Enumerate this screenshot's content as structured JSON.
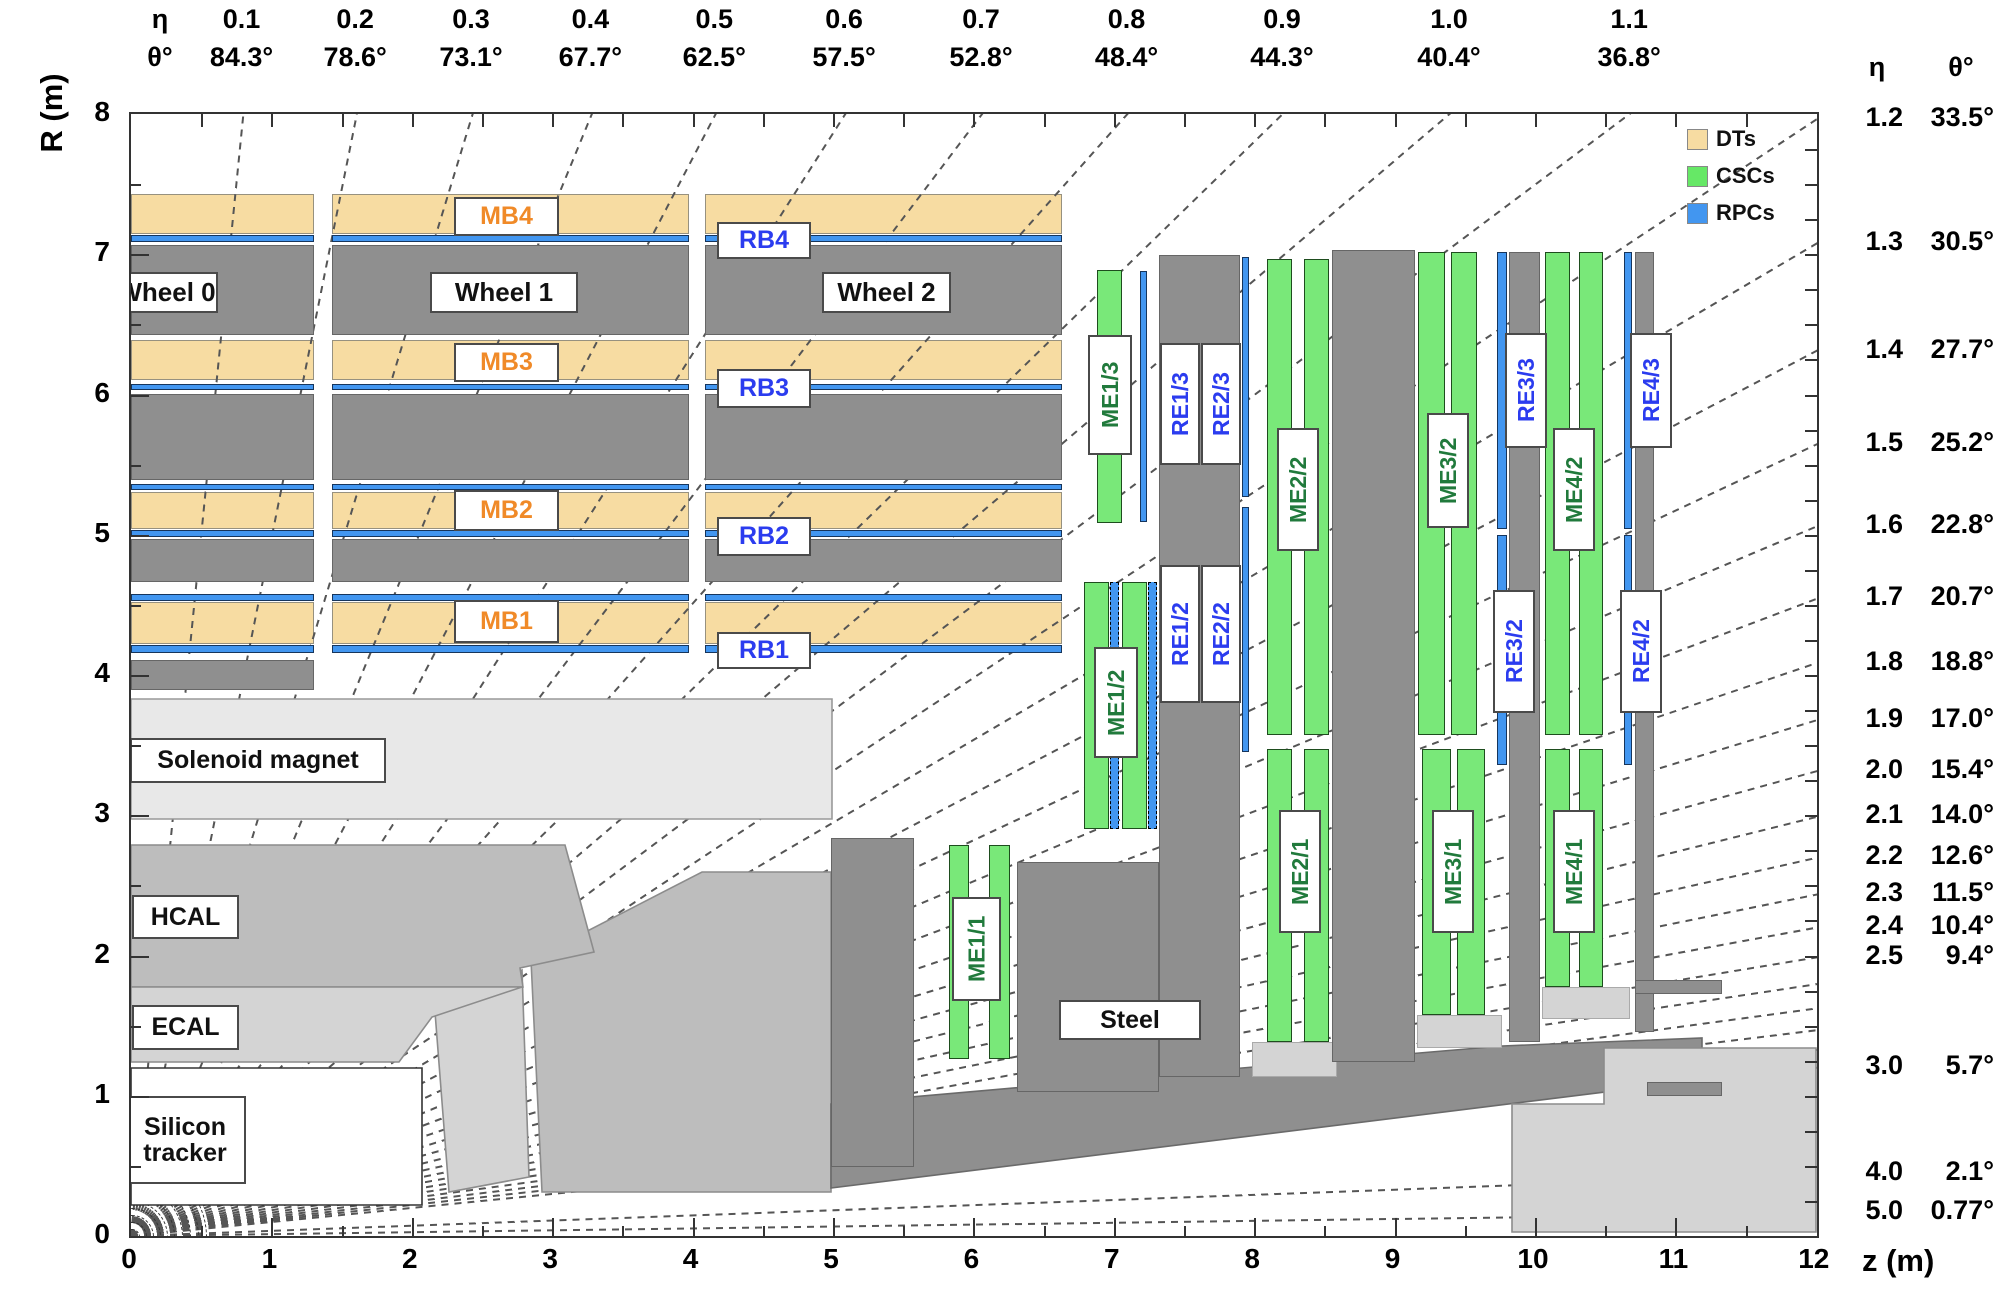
{
  "axes": {
    "r_axis_title": "R (m)",
    "z_axis_title": "z (m)",
    "r_tick_labels": [
      "0",
      "1",
      "2",
      "3",
      "4",
      "5",
      "6",
      "7",
      "8"
    ],
    "z_tick_labels": [
      "0",
      "1",
      "2",
      "3",
      "4",
      "5",
      "6",
      "7",
      "8",
      "9",
      "10",
      "11",
      "12"
    ],
    "top_header_eta": "η",
    "top_header_theta": "θ°",
    "right_header_eta": "η",
    "right_header_theta": "θ°",
    "top_eta_labels": [
      {
        "eta": "0.1",
        "theta": "84.3°"
      },
      {
        "eta": "0.2",
        "theta": "78.6°"
      },
      {
        "eta": "0.3",
        "theta": "73.1°"
      },
      {
        "eta": "0.4",
        "theta": "67.7°"
      },
      {
        "eta": "0.5",
        "theta": "62.5°"
      },
      {
        "eta": "0.6",
        "theta": "57.5°"
      },
      {
        "eta": "0.7",
        "theta": "52.8°"
      },
      {
        "eta": "0.8",
        "theta": "48.4°"
      },
      {
        "eta": "0.9",
        "theta": "44.3°"
      },
      {
        "eta": "1.0",
        "theta": "40.4°"
      },
      {
        "eta": "1.1",
        "theta": "36.8°"
      }
    ],
    "right_eta_labels": [
      {
        "eta": "1.2",
        "theta": "33.5°"
      },
      {
        "eta": "1.3",
        "theta": "30.5°"
      },
      {
        "eta": "1.4",
        "theta": "27.7°"
      },
      {
        "eta": "1.5",
        "theta": "25.2°"
      },
      {
        "eta": "1.6",
        "theta": "22.8°"
      },
      {
        "eta": "1.7",
        "theta": "20.7°"
      },
      {
        "eta": "1.8",
        "theta": "18.8°"
      },
      {
        "eta": "1.9",
        "theta": "17.0°"
      },
      {
        "eta": "2.0",
        "theta": "15.4°"
      },
      {
        "eta": "2.1",
        "theta": "14.0°"
      },
      {
        "eta": "2.2",
        "theta": "12.6°"
      },
      {
        "eta": "2.3",
        "theta": "11.5°"
      },
      {
        "eta": "2.4",
        "theta": "10.4°"
      },
      {
        "eta": "2.5",
        "theta": "9.4°"
      },
      {
        "eta": "3.0",
        "theta": "5.7°"
      },
      {
        "eta": "4.0",
        "theta": "2.1°"
      },
      {
        "eta": "5.0",
        "theta": "0.77°"
      }
    ],
    "unlabeled_eta_lines": [
      2.6,
      2.7,
      2.8,
      2.9
    ]
  },
  "legend": [
    {
      "label": "DTs",
      "color": "#F7DCA2",
      "icon": "dt-swatch"
    },
    {
      "label": "CSCs",
      "color": "#66E866",
      "icon": "csc-swatch"
    },
    {
      "label": "RPCs",
      "color": "#4296F0",
      "icon": "rpc-swatch"
    }
  ],
  "colors": {
    "dt_tan": "#F7DCA2",
    "csc_green": "#79E879",
    "rpc_blue": "#4296F0",
    "steel_gray": "#8F8F8F",
    "solenoid": "#E8E8E8",
    "hcal": "#BDBDBD",
    "ecal": "#D4D4D4",
    "light_steel": "#D4D4D4",
    "mb_text": "#F08A28",
    "rb_text": "#2B3CEF",
    "me_text": "#217A3C"
  },
  "geometry": {
    "frame": {
      "x0": 129,
      "y0": 112,
      "x1": 1815,
      "y1": 1234
    },
    "origin": {
      "x": 129,
      "y": 1234
    },
    "px_per_m_z": 140.4,
    "px_per_m_r": 140.25,
    "wheels": [
      [
        129,
        312
      ],
      [
        330,
        687
      ],
      [
        703,
        1060
      ]
    ],
    "tan_rows": [
      [
        192,
        232
      ],
      [
        338,
        378
      ],
      [
        490,
        527
      ],
      [
        600,
        642
      ]
    ],
    "rpc_rows": [
      [
        233,
        240
      ],
      [
        382,
        388
      ],
      [
        482,
        488
      ],
      [
        528,
        535
      ],
      [
        592,
        599
      ],
      [
        643,
        651
      ]
    ],
    "gray_rows": [
      [
        243,
        333
      ],
      [
        392,
        478
      ],
      [
        537,
        580
      ]
    ],
    "wheel0_stub": [
      129,
      312,
      658,
      688
    ],
    "beam_arc_radii": [
      7,
      14,
      21,
      28,
      35,
      42,
      50,
      58,
      66,
      74
    ],
    "green_bars": [
      [
        947,
        967,
        843,
        1057
      ],
      [
        987,
        1008,
        843,
        1057
      ],
      [
        1082,
        1107,
        580,
        827
      ],
      [
        1120,
        1145,
        580,
        827
      ],
      [
        1095,
        1120,
        268,
        521
      ],
      [
        1265,
        1290,
        257,
        733
      ],
      [
        1302,
        1327,
        257,
        733
      ],
      [
        1265,
        1290,
        747,
        1040
      ],
      [
        1302,
        1327,
        747,
        1040
      ],
      [
        1416,
        1443,
        250,
        733
      ],
      [
        1449,
        1475,
        250,
        733
      ],
      [
        1420,
        1449,
        747,
        1013
      ],
      [
        1455,
        1483,
        747,
        1013
      ],
      [
        1543,
        1568,
        250,
        733
      ],
      [
        1577,
        1601,
        250,
        733
      ],
      [
        1543,
        1568,
        747,
        985
      ],
      [
        1577,
        1601,
        747,
        985
      ]
    ],
    "rpc_dashed_bars": [
      [
        1108,
        1117,
        580,
        827
      ],
      [
        1146,
        1155,
        580,
        827
      ]
    ],
    "rpc_solid_bars": [
      [
        1138,
        1145,
        269,
        520
      ],
      [
        1240,
        1247,
        255,
        495
      ],
      [
        1240,
        1247,
        505,
        750
      ],
      [
        1495,
        1505,
        250,
        527
      ],
      [
        1495,
        1505,
        533,
        763
      ],
      [
        1622,
        1630,
        250,
        527
      ],
      [
        1622,
        1630,
        533,
        763
      ]
    ],
    "steel_rects": [
      [
        1157,
        1238,
        253,
        1075
      ],
      [
        1330,
        1413,
        248,
        1060
      ],
      [
        1507,
        1538,
        250,
        1040
      ],
      [
        1633,
        1652,
        250,
        1030
      ],
      [
        829,
        912,
        836,
        1165
      ],
      [
        1015,
        1157,
        860,
        1090
      ],
      [
        1633,
        1720,
        978,
        992
      ],
      [
        1645,
        1720,
        1080,
        1094
      ]
    ],
    "light_pad_rects": [
      [
        1250,
        1335,
        1040,
        1075
      ],
      [
        1415,
        1500,
        1013,
        1046
      ],
      [
        1540,
        1628,
        985,
        1017
      ]
    ],
    "polygons": {
      "hcal_endcap": [
        [
          529,
          958
        ],
        [
          700,
          870
        ],
        [
          829,
          870
        ],
        [
          829,
          1190
        ],
        [
          540,
          1190
        ]
      ],
      "ecal_endcap": [
        [
          433,
          1010
        ],
        [
          520,
          968
        ],
        [
          527,
          1175
        ],
        [
          447,
          1190
        ]
      ],
      "steel_wedge": [
        [
          829,
          1102
        ],
        [
          1240,
          1066
        ],
        [
          1500,
          1044
        ],
        [
          1700,
          1036
        ],
        [
          1700,
          1078
        ],
        [
          829,
          1186
        ]
      ],
      "solenoid": [
        [
          129,
          697
        ],
        [
          830,
          697
        ],
        [
          830,
          817
        ],
        [
          129,
          817
        ]
      ],
      "hcal_barrel": [
        [
          129,
          843
        ],
        [
          563,
          843
        ],
        [
          592,
          950
        ],
        [
          518,
          966
        ],
        [
          521,
          985
        ],
        [
          129,
          985
        ]
      ],
      "ecal_barrel": [
        [
          129,
          985
        ],
        [
          520,
          985
        ],
        [
          430,
          1015
        ],
        [
          397,
          1060
        ],
        [
          129,
          1060
        ]
      ],
      "tracker": [
        [
          129,
          1066
        ],
        [
          420,
          1066
        ],
        [
          420,
          1203
        ],
        [
          129,
          1203
        ]
      ],
      "shield": [
        [
          1510,
          1102
        ],
        [
          1602,
          1102
        ],
        [
          1602,
          1046
        ],
        [
          1814,
          1046
        ],
        [
          1814,
          1230
        ],
        [
          1510,
          1230
        ]
      ]
    }
  },
  "labels": {
    "wheels": [
      {
        "text": "Wheel 0",
        "box": [
          113,
          212,
          270,
          307
        ]
      },
      {
        "text": "Wheel 1",
        "box": [
          428,
          572,
          270,
          307
        ]
      },
      {
        "text": "Wheel 2",
        "box": [
          820,
          945,
          270,
          307
        ]
      }
    ],
    "mb": [
      {
        "text": "MB4",
        "box": [
          452,
          553,
          195,
          230
        ]
      },
      {
        "text": "MB3",
        "box": [
          452,
          553,
          341,
          376
        ]
      },
      {
        "text": "MB2",
        "box": [
          452,
          553,
          488,
          525
        ]
      },
      {
        "text": "MB1",
        "box": [
          452,
          553,
          598,
          637
        ]
      }
    ],
    "rb": [
      {
        "text": "RB4",
        "box": [
          715,
          805,
          220,
          253
        ]
      },
      {
        "text": "RB3",
        "box": [
          715,
          805,
          367,
          402
        ]
      },
      {
        "text": "RB2",
        "box": [
          715,
          805,
          515,
          550
        ]
      },
      {
        "text": "RB1",
        "box": [
          715,
          805,
          630,
          663
        ]
      }
    ],
    "me": [
      {
        "text": "ME1/1",
        "box": [
          950,
          995,
          895,
          995
        ]
      },
      {
        "text": "ME1/2",
        "box": [
          1092,
          1132,
          645,
          752
        ]
      },
      {
        "text": "ME1/3",
        "box": [
          1086,
          1126,
          333,
          449
        ]
      },
      {
        "text": "ME2/1",
        "box": [
          1277,
          1315,
          808,
          927
        ]
      },
      {
        "text": "ME2/2",
        "box": [
          1275,
          1313,
          426,
          545
        ]
      },
      {
        "text": "ME3/1",
        "box": [
          1430,
          1468,
          808,
          927
        ]
      },
      {
        "text": "ME3/2",
        "box": [
          1425,
          1463,
          411,
          522
        ]
      },
      {
        "text": "ME4/1",
        "box": [
          1551,
          1589,
          808,
          927
        ]
      },
      {
        "text": "ME4/2",
        "box": [
          1551,
          1589,
          426,
          545
        ]
      }
    ],
    "re": [
      {
        "text": "RE1/2",
        "box": [
          1158,
          1194,
          563,
          697
        ]
      },
      {
        "text": "RE2/2",
        "box": [
          1199,
          1235,
          563,
          697
        ]
      },
      {
        "text": "RE1/3",
        "box": [
          1158,
          1194,
          341,
          459
        ]
      },
      {
        "text": "RE2/3",
        "box": [
          1199,
          1235,
          341,
          459
        ]
      },
      {
        "text": "RE3/2",
        "box": [
          1491,
          1529,
          588,
          707
        ]
      },
      {
        "text": "RE3/3",
        "box": [
          1503,
          1541,
          331,
          442
        ]
      },
      {
        "text": "RE4/2",
        "box": [
          1618,
          1656,
          588,
          707
        ]
      },
      {
        "text": "RE4/3",
        "box": [
          1628,
          1666,
          331,
          442
        ]
      }
    ],
    "regions": [
      {
        "text": "Solenoid magnet",
        "box": [
          128,
          380,
          736,
          777
        ]
      },
      {
        "text": "HCAL",
        "box": [
          130,
          233,
          893,
          933
        ]
      },
      {
        "text": "ECAL",
        "box": [
          130,
          233,
          1003,
          1044
        ]
      },
      {
        "text": "Silicon\ntracker",
        "box": [
          122,
          240,
          1094,
          1178
        ]
      },
      {
        "text": "Steel",
        "box": [
          1057,
          1195,
          998,
          1034
        ]
      }
    ]
  }
}
